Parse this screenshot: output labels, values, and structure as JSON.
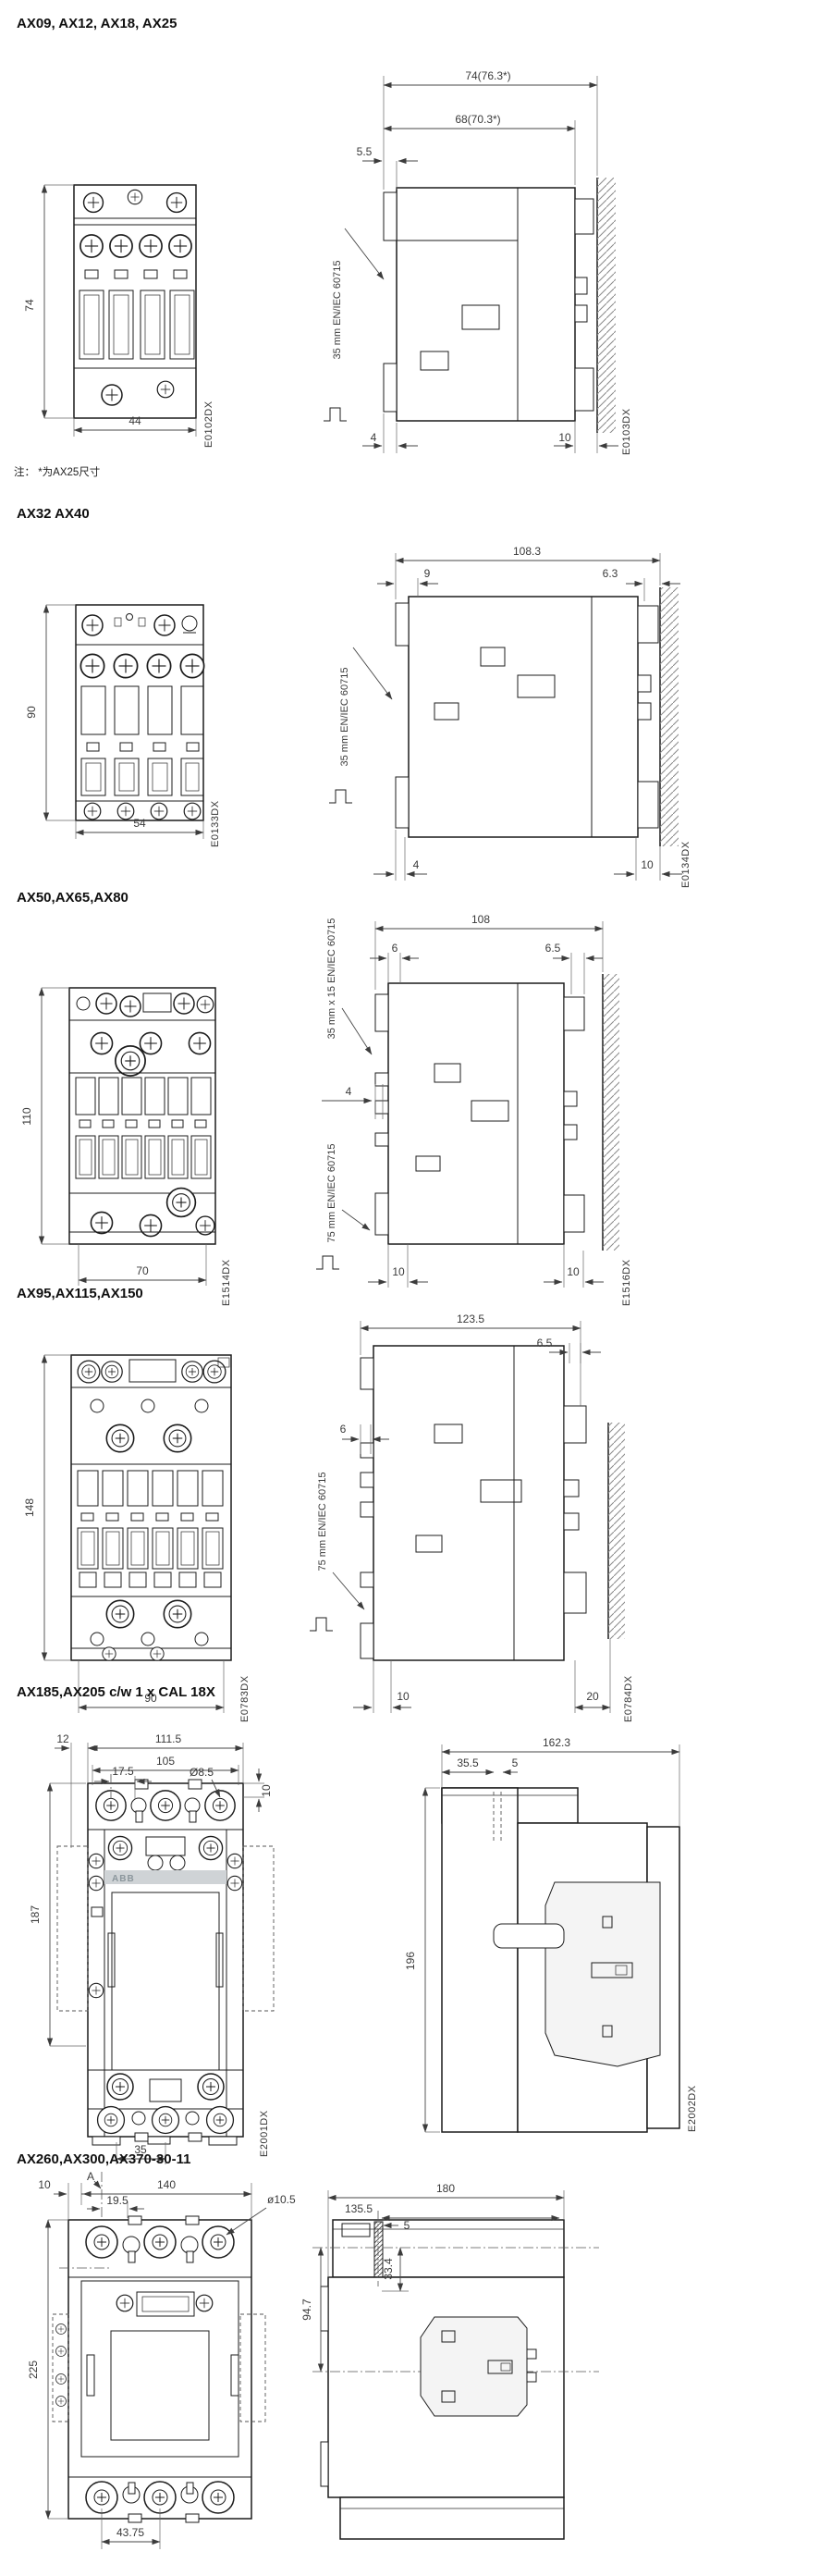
{
  "note": "注： *为AX25尺寸",
  "sections": [
    {
      "title": "AX09, AX12, AX18, AX25",
      "front": {
        "h": "74",
        "w": "44",
        "code": "E0102DX"
      },
      "side": {
        "w1": "74(76.3*)",
        "w2": "68(70.3*)",
        "d1": "5.5",
        "rail": "35 mm EN/IEC 60715",
        "b1": "4",
        "b2": "10",
        "code": "E0103DX"
      }
    },
    {
      "title": "AX32 AX40",
      "front": {
        "h": "90",
        "w": "54",
        "code": "E0133DX"
      },
      "side": {
        "w1": "108.3",
        "d1": "9",
        "d2": "6.3",
        "rail": "35 mm EN/IEC 60715",
        "b1": "4",
        "b2": "10",
        "code": "E0134DX"
      }
    },
    {
      "title": "AX50,AX65,AX80",
      "front": {
        "h": "110",
        "w": "70",
        "code": "E1514DX"
      },
      "side": {
        "w1": "108",
        "d1": "6",
        "d2": "6.5",
        "rail1": "35 mm x 15 EN/IEC 60715",
        "mid": "4",
        "rail2": "75 mm EN/IEC 60715",
        "b1": "10",
        "b2": "10",
        "code": "E1516DX"
      }
    },
    {
      "title": "AX95,AX115,AX150",
      "front": {
        "h": "148",
        "w": "90",
        "code": "E0783DX"
      },
      "side": {
        "w1": "123.5",
        "d1": "6",
        "d2": "6.5",
        "rail": "75 mm EN/IEC 60715",
        "b1": "10",
        "b2": "20",
        "code": "E0784DX"
      }
    },
    {
      "title": "AX185,AX205 c/w 1 x CAL 18X",
      "front": {
        "off_left": "12",
        "w_outer": "111.5",
        "w_inner": "105",
        "pitch": "17.5",
        "hole": "Ø8.5",
        "off_top": "10",
        "h": "187",
        "brand": "ABB",
        "w_bottom": "35",
        "code": "E2001DX"
      },
      "side": {
        "w1": "162.3",
        "d1": "35.5",
        "d2": "5",
        "h": "196",
        "code": "E2002DX"
      }
    },
    {
      "title": "AX260,AX300,AX370-30-11",
      "front": {
        "marker": "A",
        "off_left": "10",
        "w_outer": "140",
        "pitch": "19.5",
        "hole": "ø10.5",
        "h": "225",
        "w_bottom": "43.75"
      },
      "side": {
        "w1": "180",
        "d1": "135.5",
        "d2": "5",
        "v1": "94.7",
        "v2": "33.4"
      }
    }
  ]
}
